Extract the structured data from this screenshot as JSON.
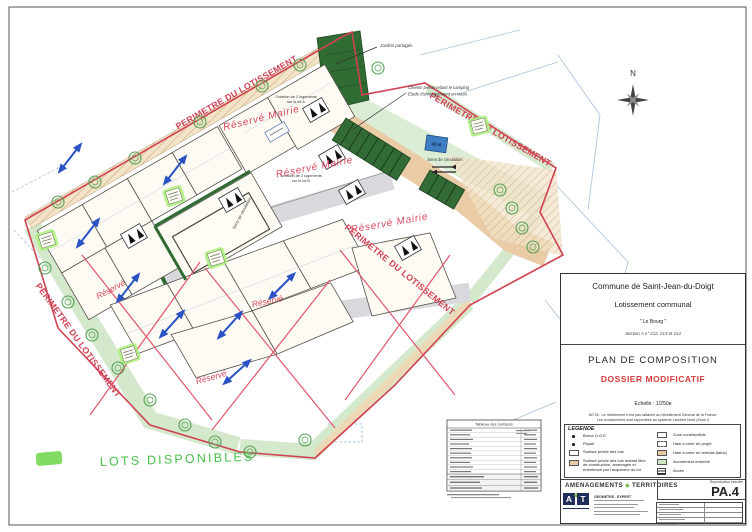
{
  "document": {
    "commune": "Commune de Saint-Jean-du-Doigt",
    "operation": "Lotissement communal",
    "lieu_dit": "\" Le Bourg \"",
    "section": "Section A n° 212, 213 et 214",
    "title": "PLAN DE COMPOSITION",
    "subtitle": "DOSSIER MODIFICATIF",
    "echelle": "Echelle : 1/250e",
    "nota_line1": "NOTA : Le nivellement n'est pas rattaché au Nivellement Général de la France.",
    "nota_line2": "Les coordonnées sont rapportées au système Lambert Nord (Zone I)",
    "sheet_number": "PA.4",
    "reproduction": "Reproduction interdite"
  },
  "legend": {
    "title": "LEGENDE",
    "items_left": [
      {
        "label": "Borne O.G.E."
      },
      {
        "label": "Piquet"
      },
      {
        "label": "Surface privée des lots"
      },
      {
        "label": "Surface privée des lots restant libre de construction, aménagée et entretenue par l'acquéreur du lot"
      }
    ],
    "items_right": [
      {
        "label": "Zone constructible"
      },
      {
        "label": "Haie à créer en projet"
      },
      {
        "label": "Haie à créer en remblai (talus)"
      },
      {
        "label": "Accotement enherbé"
      },
      {
        "label": "Accès"
      }
    ]
  },
  "firm": {
    "name_left": "AMENAGEMENTS",
    "name_right": "TERRITOIRES",
    "logo_a": "A",
    "logo_t": "T",
    "profession": "GEOMETRE - EXPERT"
  },
  "map": {
    "perimeter_label": "PERIMETRE DU LOTISSEMENT",
    "north": "N",
    "jardins_label": "Jardins partagés",
    "chemin_line1": "Chemin piéton reliant le camping",
    "chemin_line2": "Etude d'aménagement en cours",
    "sens_circulation": "Sens de circulation",
    "creation_lot_a_line1": "Création de 2 logements",
    "creation_lot_a_line2": "sur le lot A",
    "creation_lot_b_line1": "Création de 2 logements",
    "creation_lot_b_line2": "sur le lot B",
    "parking_tag": "40 M",
    "reserve_mairie": "Réservé Mairie",
    "reserve": "Réservé",
    "lots_disponibles": "LOTS DISPONIBLES",
    "surface_table_title": "Tableau des surfaces"
  }
}
